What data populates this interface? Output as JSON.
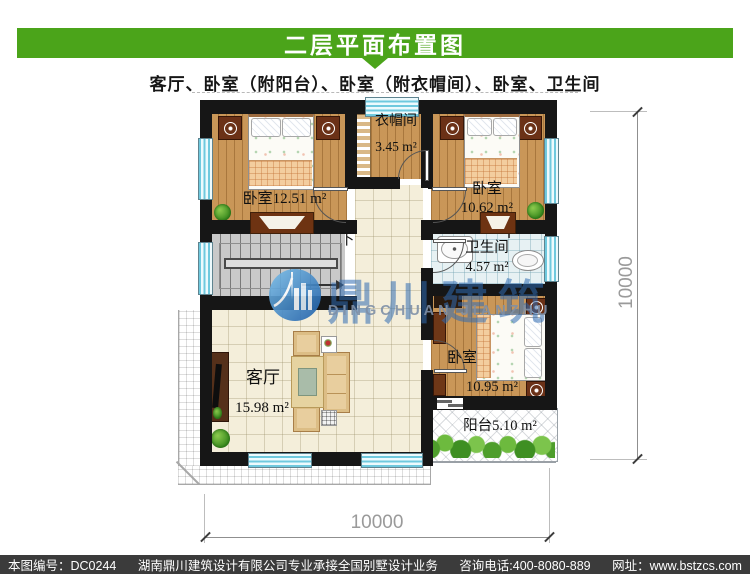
{
  "header": {
    "title": "二层平面布置图",
    "subtitle": "客厅、卧室（附阳台）、卧室（附衣帽间）、卧室、卫生间"
  },
  "plan": {
    "rooms": {
      "bedroom_tl": {
        "label": "卧室12.51 m²"
      },
      "cloakroom": {
        "name": "衣帽间",
        "area": "3.45 m²"
      },
      "bedroom_tr": {
        "name": "卧室",
        "area": "10.62 m²"
      },
      "bathroom": {
        "name": "卫生间",
        "area": "4.57 m²"
      },
      "living": {
        "name": "客厅",
        "area": "15.98 m²"
      },
      "bedroom_br": {
        "name": "卧室",
        "area": "10.95 m²"
      },
      "balcony": {
        "label": "阳台5.10 m²"
      }
    },
    "stairs": {
      "direction_label": "下"
    },
    "dimensions": {
      "right": "10000",
      "bottom": "10000"
    }
  },
  "watermark": {
    "cn": "鼎川建筑",
    "en": "DINGCHUAN JIANZHU"
  },
  "footer": {
    "drawing_no": "本图编号：DC0244",
    "company": "湖南鼎川建筑设计有限公司专业承接全国别墅设计业务",
    "phone": "咨询电话:400-8080-889",
    "website": "网址：www.bstzcs.com"
  },
  "colors": {
    "accent_green": "#4BA41A",
    "footer_bg": "#3B3B3B",
    "watermark_blue": "#2F6BB3",
    "window_cyan": "#7ECFE2"
  }
}
